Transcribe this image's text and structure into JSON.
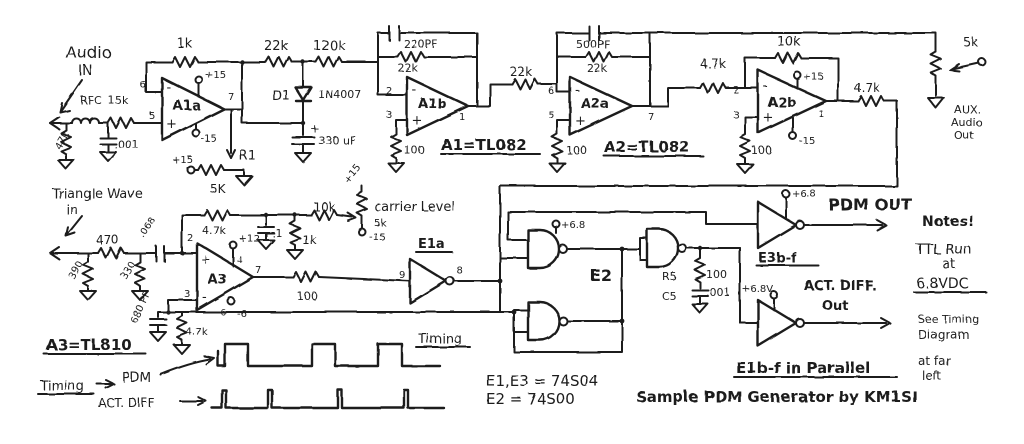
{
  "title": "Sample PDM Generator by KM1SI",
  "colors": {
    "ink": "#1d1d1d",
    "paper": "#ffffff"
  },
  "audio_in": {
    "t1": "Audio",
    "t2": "IN",
    "rfc": "RFC",
    "r15k": "15k",
    "r47k": "47k",
    "c001": ".001"
  },
  "a1a": {
    "name": "A1a",
    "p6": "6",
    "p5": "5",
    "p7": "7",
    "vp": "+15",
    "vm": "-15",
    "rfb": "1k",
    "minus": "-",
    "plus": "+"
  },
  "r1": {
    "vp": "+15",
    "name": "R1",
    "val": "5K"
  },
  "interstage": {
    "r22k": "22k",
    "r120k": "120k",
    "d1": "D1",
    "d1t": "1N4007",
    "cplus": "+",
    "c330": "330 uF"
  },
  "a1b": {
    "name": "A1b",
    "cfb": "220PF",
    "rfb": "22k",
    "p2": "2",
    "p3": "3",
    "p1": "1",
    "rg": "100",
    "eq": "A1=TL082",
    "rs": "22k",
    "minus": "-",
    "plus": "+"
  },
  "a2a": {
    "name": "A2a",
    "cfb": "500PF",
    "rfb": "22k",
    "p6": "6",
    "p5": "5",
    "p7": "7",
    "rg": "100",
    "eq": "A2=TL082",
    "minus": "-",
    "plus": "+"
  },
  "a2b": {
    "name": "A2b",
    "rin": "4.7k",
    "rfb": "10k",
    "vp": "+15",
    "vm": "-15",
    "p2": "2",
    "p3": "3",
    "p1": "1",
    "rg": "100",
    "rout": "4.7k",
    "minus": "-",
    "plus": "+"
  },
  "aux": {
    "pot": "5k",
    "t1": "AUX.",
    "t2": "Audio",
    "t3": "Out"
  },
  "tri_in": {
    "t1": "Triangle Wave",
    "t2": "in",
    "r470": "470",
    "r390": "390",
    "r330": "330",
    "c068": ".068",
    "c680": "680 PF",
    "r47k": "4.7k"
  },
  "a3": {
    "name": "A3",
    "p2": "2",
    "p3": "3",
    "p4": "4",
    "p6": "6",
    "p7": "7",
    "vp": "+12",
    "vm": "-6",
    "plus": "+",
    "minus": "-",
    "rfb": "4.7k",
    "c1": ".1",
    "r1k": "1k",
    "r10k": "10k",
    "rout": "100",
    "eq": "A3=TL810"
  },
  "carrier": {
    "vp": "+15",
    "label": "carrier Level",
    "val": "5k",
    "vm": "-15"
  },
  "e1a": {
    "name": "E1a",
    "pin_in": "9",
    "pin_out": "8"
  },
  "e2": {
    "name": "E2",
    "vcc": "+6.8",
    "r5": "R5",
    "r5v": "100",
    "c5": "C5",
    "c5v": ".001"
  },
  "pdm_out": {
    "vcc": "+6.8",
    "label": "PDM OUT",
    "name": "E3b-f"
  },
  "act_out": {
    "vcc": "+6.8V",
    "l1": "ACT. DIFF.",
    "l2": "Out"
  },
  "notes": {
    "t1": "Notes!",
    "t2": "TTL Run",
    "t3": "at",
    "t4": "6.8VDC",
    "t5": "See Timing",
    "t6": "Diagram",
    "t7": "at far",
    "t8": "left"
  },
  "footer": {
    "parallel": "E1b-f in Parallel",
    "caption": "Sample PDM Generator by KM1SI",
    "e1e3": "E1,E3 = 74S04",
    "e2eq": "E2 = 74S00",
    "timing_mid": "Timing"
  },
  "timing": {
    "left": "Timing",
    "pdm": "PDM",
    "act": "ACT. DIFF"
  }
}
